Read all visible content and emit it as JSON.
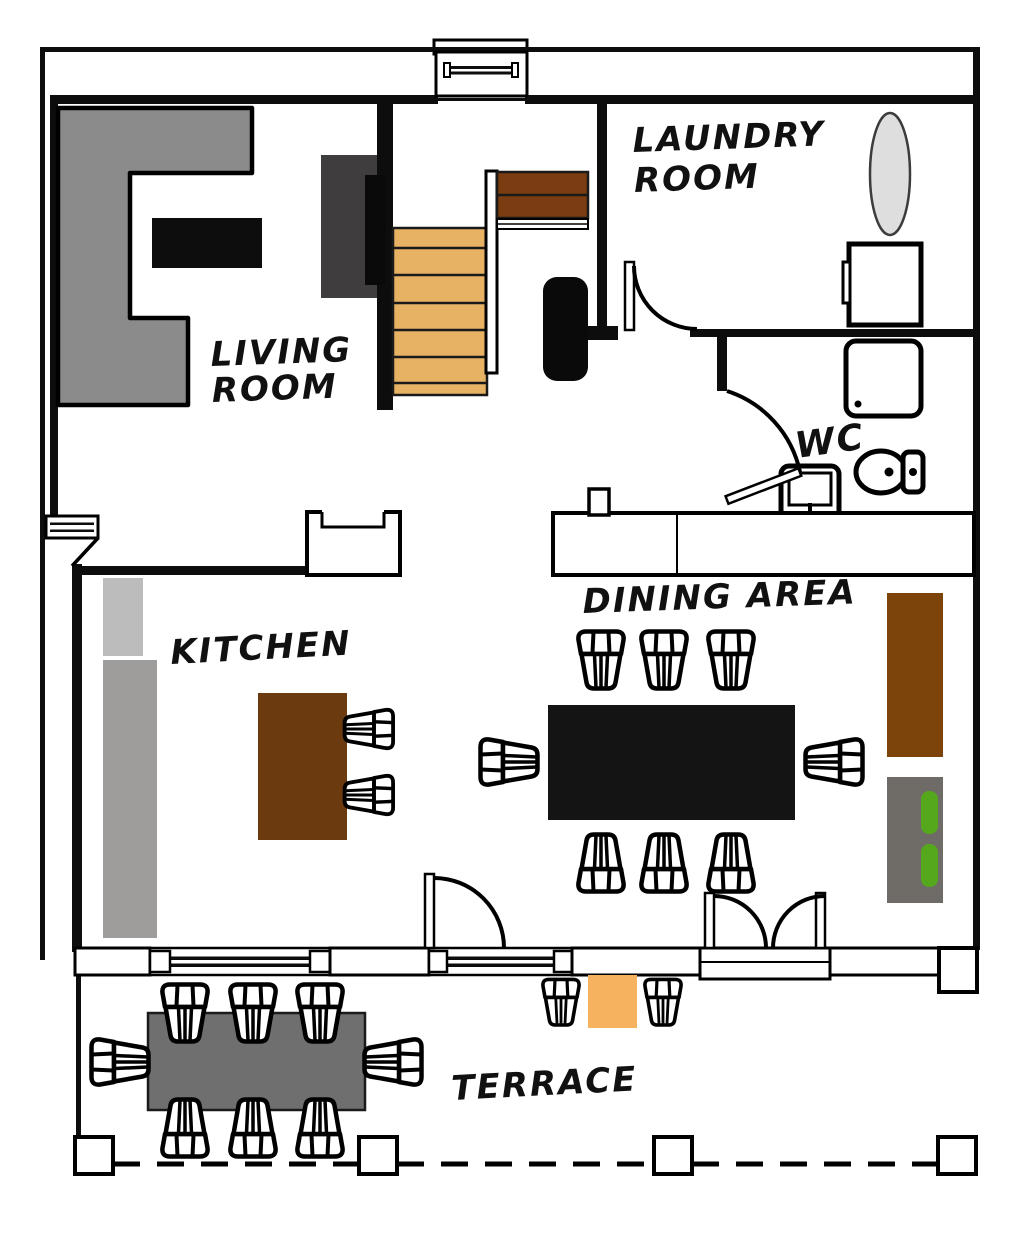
{
  "diagram": {
    "type": "floor-plan",
    "rooms": {
      "living": {
        "line1": "LIVING",
        "line2": "ROOM"
      },
      "laundry": {
        "line1": "LAUNDRY",
        "line2": "ROOM"
      },
      "wc": {
        "label": "WC"
      },
      "kitchen": {
        "label": "KITCHEN"
      },
      "dining": {
        "label": "DINING AREA"
      },
      "terrace": {
        "label": "TERRACE"
      }
    },
    "colors": {
      "wall": "#0d0d0d",
      "background": "#ffffff",
      "sofa": "#8b8b8b",
      "coffee_table": "#0d0d0d",
      "tv_unit": "#3f3d3e",
      "tv": "#0a0a0a",
      "stairs_lower": "#e8b264",
      "stairs_upper": "#7a3c10",
      "bench": "#0a0a0a",
      "laundry_basket": "#dedede",
      "counter_light": "#bcbcbc",
      "counter_dark": "#9e9d9b",
      "island": "#6b3a0e",
      "dining_table": "#141414",
      "sideboard": "#7c430b",
      "shelf": "#6f6b67",
      "plants": "#55a81c",
      "terrace_table": "#6f6f6f",
      "bistro_table": "#f6b25e"
    }
  }
}
